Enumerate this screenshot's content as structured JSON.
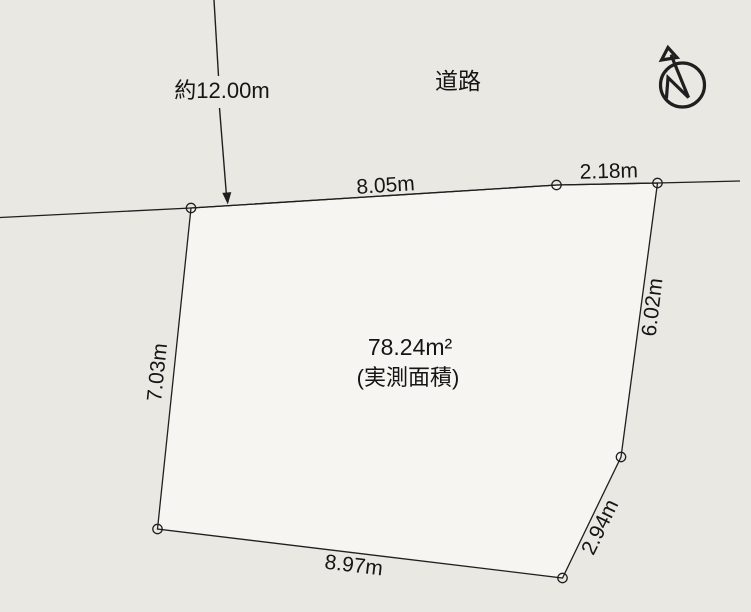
{
  "colors": {
    "background": "#e9e8e3",
    "parcel_fill": "#f6f5f1",
    "line": "#1f1f1f",
    "text": "#151515"
  },
  "labels": {
    "road": "道路",
    "road_width": "約12.00m",
    "area_value": "78.24m²",
    "area_caption": "(実測面積)"
  },
  "edges": {
    "top": "8.05m",
    "top_right": "2.18m",
    "right": "6.02m",
    "lower_right": "2.94m",
    "bottom": "8.97m",
    "left": "7.03m"
  },
  "compass": {
    "icon": "north-arrow"
  }
}
